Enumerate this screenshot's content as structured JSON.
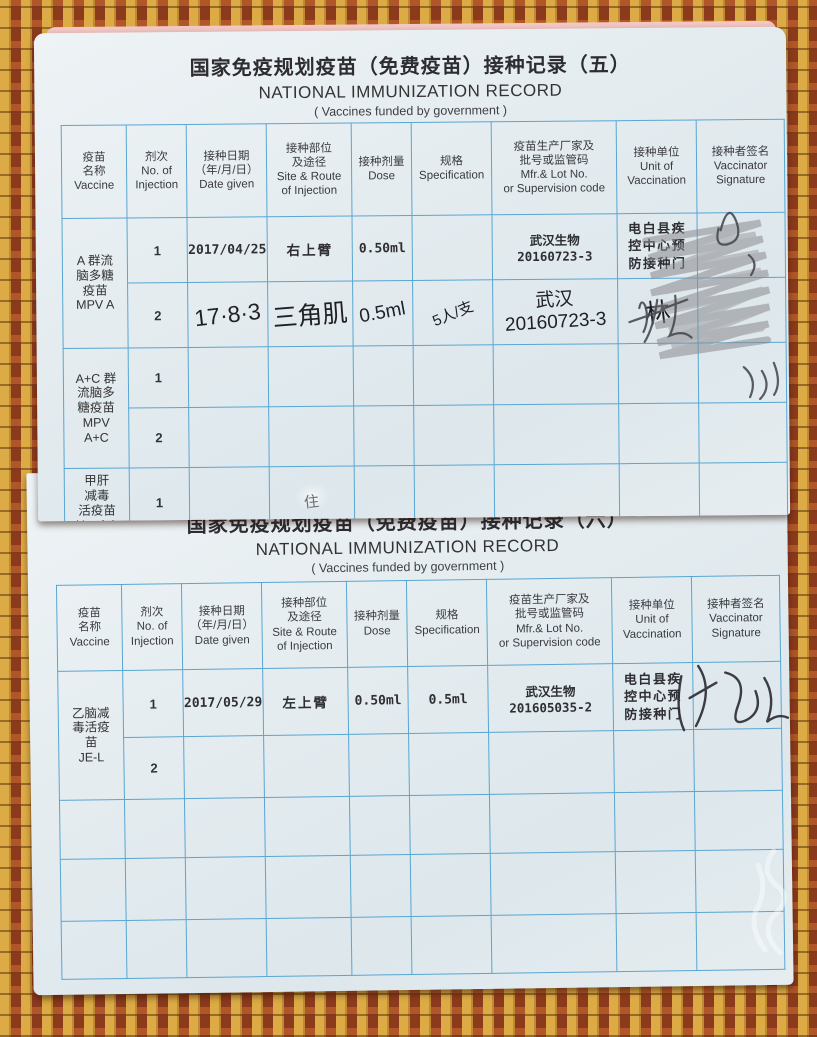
{
  "colors": {
    "page_background": "#e3ebef",
    "grid_line": "#58a6d2",
    "mat_yellow": "#dcab45",
    "mat_red": "#a24a24",
    "stamp_ink": "#2e2e33",
    "pencil_gray": "#8b8b8f"
  },
  "table_headers": [
    {
      "text": [
        "疫苗",
        "名称",
        "Vaccine"
      ]
    },
    {
      "text": [
        "剂次",
        "No. of",
        "Injection"
      ]
    },
    {
      "text": [
        "接种日期",
        "（年/月/日）",
        "Date given"
      ]
    },
    {
      "text": [
        "接种部位",
        "及途径",
        "Site & Route",
        "of Injection"
      ]
    },
    {
      "text": [
        "接种剂量",
        "Dose"
      ]
    },
    {
      "text": [
        "规格",
        "Specification"
      ]
    },
    {
      "text": [
        "疫苗生产厂家及",
        "批号或监管码",
        "Mfr.& Lot No.",
        "or Supervision code"
      ]
    },
    {
      "text": [
        "接种单位",
        "Unit of",
        "Vaccination"
      ]
    },
    {
      "text": [
        "接种者签名",
        "Vaccinator",
        "Signature"
      ]
    }
  ],
  "page5": {
    "title_cn": "国家免疫规划疫苗（免费疫苗）接种记录（五）",
    "title_en": "NATIONAL IMMUNIZATION RECORD",
    "subtitle": "( Vaccines funded by government )",
    "records": {
      "mpva": {
        "name": [
          "A 群流",
          "脑多糖",
          "疫苗",
          "MPV A"
        ],
        "rows": [
          {
            "no": "1",
            "date": "2017/04/25",
            "site": "右上臂",
            "dose": "0.50ml",
            "spec": "",
            "mfr": [
              "武汉生物",
              "20160723-3"
            ],
            "unit": [
              "电白县疾",
              "控中心预",
              "防接种门"
            ],
            "signature": ""
          },
          {
            "no": "2",
            "date": "17·8·3",
            "site": "三角肌",
            "dose": "0.5ml",
            "spec": "5人/支",
            "mfr": [
              "武汉",
              "20160723-3"
            ],
            "unit": "林",
            "signature": ""
          }
        ]
      },
      "mpvac": {
        "name": [
          "A+C 群",
          "流脑多",
          "糖疫苗",
          "MPV",
          "A+C"
        ],
        "rows": [
          {
            "no": "1"
          },
          {
            "no": "2"
          }
        ]
      },
      "hepa": {
        "name": [
          "甲肝",
          "减毒",
          "活疫苗",
          "HepA-L"
        ],
        "rows": [
          {
            "no": "1",
            "mark": "住"
          }
        ]
      }
    }
  },
  "page6": {
    "title_cn": "国家免疫规划疫苗（免费疫苗）接种记录（六）",
    "title_en": "NATIONAL IMMUNIZATION RECORD",
    "subtitle": "( Vaccines funded by government )",
    "records": {
      "jel": {
        "name": [
          "乙脑减",
          "毒活疫",
          "苗",
          "JE-L"
        ],
        "rows": [
          {
            "no": "1",
            "date": "2017/05/29",
            "site": "左上臂",
            "dose": "0.50ml",
            "spec": "0.5ml",
            "mfr": [
              "武汉生物",
              "201605035-2"
            ],
            "unit": [
              "电白县疾",
              "控中心预",
              "防接种门"
            ],
            "signature": ""
          },
          {
            "no": "2"
          }
        ]
      },
      "empty_row_count": 3
    }
  }
}
